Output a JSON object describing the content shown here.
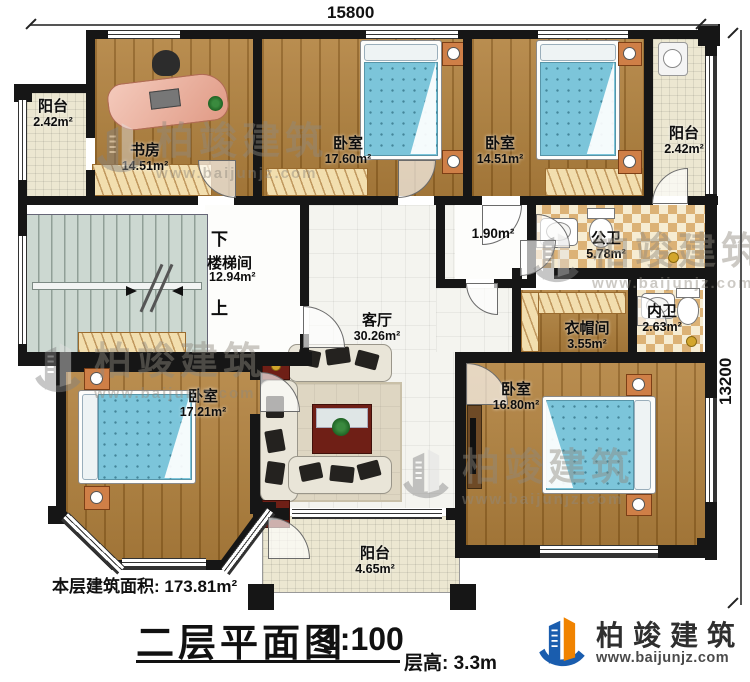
{
  "dimensions": {
    "width_top": "15800",
    "height_right": "13200"
  },
  "rooms": {
    "balcony_top_left": {
      "name": "阳台",
      "area": "2.42m²"
    },
    "study": {
      "name": "书房",
      "area": "14.51m²"
    },
    "bedroom_top_middle": {
      "name": "卧室",
      "area": "17.60m²"
    },
    "bedroom_top_right": {
      "name": "卧室",
      "area": "14.51m²"
    },
    "balcony_top_right": {
      "name": "阳台",
      "area": "2.42m²"
    },
    "hallway": {
      "area": "1.90m²"
    },
    "public_bathroom": {
      "name": "公卫",
      "area": "5.78m²"
    },
    "inner_bathroom": {
      "name": "内卫",
      "area": "2.63m²"
    },
    "cloakroom": {
      "name": "衣帽间",
      "area": "3.55m²"
    },
    "stairwell": {
      "name": "楼梯间",
      "area": "12.94m²",
      "down_label": "下",
      "up_label": "上"
    },
    "living_room": {
      "name": "客厅",
      "area": "30.26m²"
    },
    "bedroom_bottom_left": {
      "name": "卧室",
      "area": "17.21m²"
    },
    "bedroom_bottom_right": {
      "name": "卧室",
      "area": "16.80m²"
    },
    "balcony_bottom": {
      "name": "阳台",
      "area": "4.65m²"
    }
  },
  "footer": {
    "floor_area": "本层建筑面积: 173.81m²",
    "title": "二层平面图",
    "scale": "1:100",
    "floor_height": "层高: 3.3m"
  },
  "brand": {
    "name": "柏竣建筑",
    "url": "www.baijunjz.com"
  }
}
